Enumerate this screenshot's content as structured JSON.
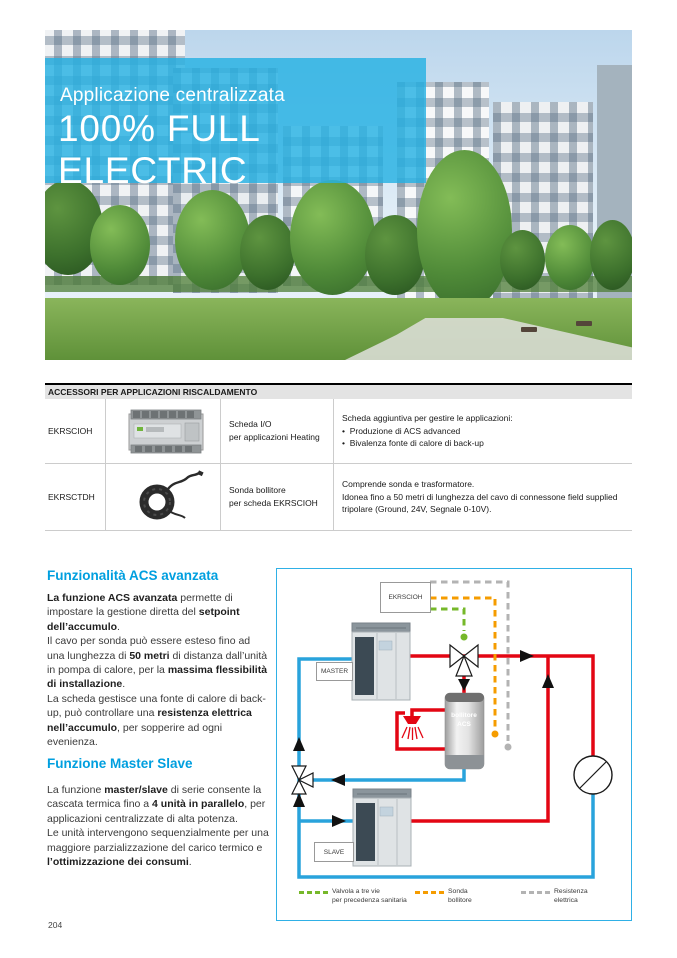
{
  "page": {
    "number": "204"
  },
  "hero": {
    "subtitle": "Applicazione centralizzata",
    "title": "100% FULL ELECTRIC",
    "overlay_color": "#26b1e3"
  },
  "accessory_table": {
    "header": "ACCESSORI PER APPLICAZIONI RISCALDAMENTO",
    "rows": [
      {
        "code": "EKRSCIOH",
        "image": "io-module",
        "name_line1": "Scheda I/O",
        "name_line2": "per applicazioni Heating",
        "desc_html": "Scheda aggiuntiva per gestire le applicazioni:<br>•&nbsp; Produzione di ACS advanced<br>•&nbsp; Bivalenza fonte di calore di back-up"
      },
      {
        "code": "EKRSCTDH",
        "image": "sensor-cable",
        "name_line1": "Sonda bollitore",
        "name_line2": "per scheda EKRSCIOH",
        "desc_html": "Comprende sonda e trasformatore.<br>Idonea fino a 50 metri di lunghezza del cavo di connessone field supplied tripolare (Ground, 24V, Segnale 0-10V)."
      }
    ]
  },
  "sections": [
    {
      "heading": "Funzionalità ACS avanzata",
      "body_html": "<b>La funzione ACS avanzata</b> permette di impostare la gestione diretta del <b>setpoint dell’accumulo</b>.<br>Il cavo per sonda può essere esteso fino ad una lunghezza di <b>50 metri</b> di distanza dall’unità in pompa di calore, per la <b>massima flessibilità di installazione</b>.<br>La scheda gestisce una fonte di calore di back-up, può controllare una <b>resistenza elettrica nell’accumulo</b>, per sopperire ad ogni evenienza."
    },
    {
      "heading": "Funzione Master Slave",
      "body_html": "La funzione <b>master/slave</b> di serie consente la cascata termica fino a <b>4 unità in parallelo</b>, per applicazioni centralizzate di alta potenza.<br>Le unità intervengono sequenzialmente per una maggiore parzializzazione del carico termico e <b>l’ottimizzazione dei consumi</b>."
    }
  ],
  "diagram": {
    "controller_label": "EKRSCIOH",
    "master_label": "MASTER",
    "slave_label": "SLAVE",
    "tank_line1": "bollitore",
    "tank_line2": "ACS",
    "legend": [
      {
        "color": "#76b82a",
        "line1": "Valvola a tre vie",
        "line2": "per precedenza sanitaria"
      },
      {
        "color": "#f59c00",
        "line1": "Sonda",
        "line2": "bollitore"
      },
      {
        "color": "#b3b3b3",
        "line1": "Resistenza",
        "line2": "elettrica"
      }
    ],
    "colors": {
      "supply_pipe": "#e30613",
      "return_pipe": "#29a3dc",
      "frame": "#2fb0e6",
      "valve_signal": "#76b82a",
      "tank_sensor": "#f59c00",
      "electric_resistance": "#b3b3b3",
      "heading_accent": "#009fdf"
    }
  }
}
